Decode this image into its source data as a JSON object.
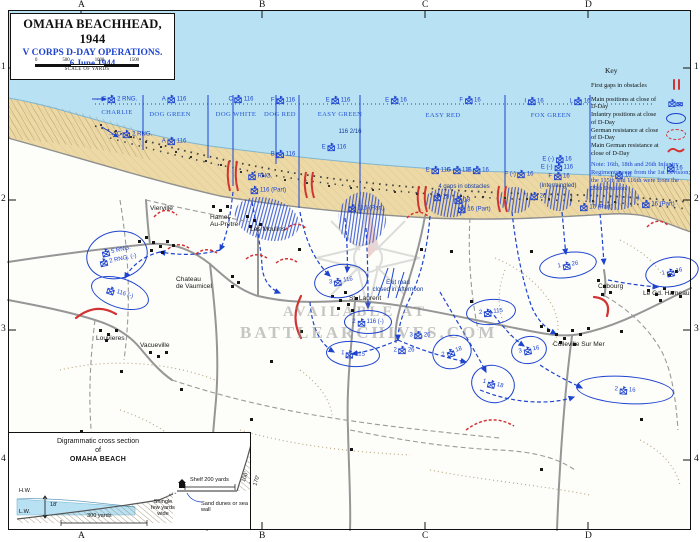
{
  "title_box": {
    "title": "OMAHA BEACHHEAD, 1944",
    "subtitle": "V CORPS D-DAY OPERATIONS.",
    "date": "6 June 1944",
    "scale_ticks": [
      "0",
      "500",
      "1000",
      "1500"
    ],
    "scale_caption": "SCALE OF YARDS"
  },
  "grid": {
    "columns": [
      "A",
      "B",
      "C",
      "D"
    ],
    "rows": [
      "1",
      "2",
      "3",
      "4"
    ]
  },
  "key": {
    "title": "Key",
    "entries": [
      {
        "label": "First gaps in obstacles",
        "symbol": "red-gap-bars"
      },
      {
        "label": "Main positions at close of D-Day",
        "symbol": "blue-unit-flag"
      },
      {
        "label": "Infantry positions at close of D-Day",
        "symbol": "blue-oval"
      },
      {
        "label": "German resistance at close of D-Day",
        "symbol": "red-dashed-oval"
      },
      {
        "label": "Main German resistance at close of D-Day",
        "symbol": "red-wavy-line"
      }
    ],
    "note": "Note: 16th, 18th and 26th Infantry Regiments were from the 1st Division; the 115th and 116th were from the 29th Division."
  },
  "watermark": {
    "line1": "AVAILABLE AT",
    "line2": "BATTLEARCHIVES.COM"
  },
  "colors": {
    "sea": "#b8e1f3",
    "sand": "#ecd9a5",
    "unit_blue": "#1d43cf",
    "resistance_red": "#d23333",
    "road_gray": "#969696"
  },
  "map": {
    "sectors": [
      {
        "name": "CHARLIE",
        "x": 117,
        "y": 109
      },
      {
        "name": "DOG GREEN",
        "x": 170,
        "y": 111
      },
      {
        "name": "DOG WHITE",
        "x": 236,
        "y": 111
      },
      {
        "name": "DOG RED",
        "x": 280,
        "y": 111
      },
      {
        "name": "EASY GREEN",
        "x": 340,
        "y": 111
      },
      {
        "name": "EASY RED",
        "x": 443,
        "y": 112
      },
      {
        "name": "FOX GREEN",
        "x": 551,
        "y": 112
      }
    ],
    "towns": [
      {
        "name": "Vierville",
        "x": 150,
        "y": 205
      },
      {
        "name": "Hamel-\nAu-Pretre",
        "x": 210,
        "y": 214
      },
      {
        "name": "Les Moulins",
        "x": 250,
        "y": 226
      },
      {
        "name": "Chateau\nde Vaumicel",
        "x": 176,
        "y": 276
      },
      {
        "name": "Louvieres",
        "x": 96,
        "y": 335
      },
      {
        "name": "Vacueville",
        "x": 140,
        "y": 342
      },
      {
        "name": "St. Laurent",
        "x": 349,
        "y": 295
      },
      {
        "name": "Colleville Sur Mer",
        "x": 553,
        "y": 341
      },
      {
        "name": "Cabourg",
        "x": 598,
        "y": 283
      },
      {
        "name": "Le Gd. Hameau",
        "x": 643,
        "y": 290
      }
    ],
    "flags": [
      {
        "pre": "C",
        "num": "2 RNG.",
        "x": 115,
        "y": 99,
        "arrow": true
      },
      {
        "pre": "A",
        "num": "116",
        "x": 174,
        "y": 99
      },
      {
        "pre": "C",
        "num": "116",
        "x": 241,
        "y": 99
      },
      {
        "pre": "F",
        "num": "116",
        "x": 283,
        "y": 100
      },
      {
        "pre": "E",
        "num": "116",
        "x": 338,
        "y": 100
      },
      {
        "pre": "E",
        "num": "16",
        "x": 396,
        "y": 100
      },
      {
        "pre": "F",
        "num": "16",
        "x": 470,
        "y": 100
      },
      {
        "pre": "I",
        "num": "16",
        "x": 534,
        "y": 101
      },
      {
        "pre": "L",
        "num": "16",
        "x": 580,
        "y": 101
      },
      {
        "pre": "C",
        "num": "2 RNG.",
        "x": 130,
        "y": 134,
        "arrow": true
      },
      {
        "pre": "A",
        "num": "116",
        "x": 174,
        "y": 141
      },
      {
        "pre": "B",
        "num": "116",
        "x": 283,
        "y": 154
      },
      {
        "pre": "E",
        "num": "116",
        "x": 334,
        "y": 147
      },
      {
        "pre": "",
        "num": "RNG.",
        "x": 260,
        "y": 176
      },
      {
        "pre": "",
        "num": "116 (Part)",
        "x": 268,
        "y": 190
      },
      {
        "pre": "",
        "num": "116 (Part)",
        "x": 366,
        "y": 208
      },
      {
        "pre": "E",
        "num": "116",
        "x": 438,
        "y": 170
      },
      {
        "pre": "G",
        "num": "116",
        "x": 459,
        "y": 170
      },
      {
        "pre": "E",
        "num": "16",
        "x": 478,
        "y": 170
      },
      {
        "pre": "F (-)",
        "num": "16",
        "x": 519,
        "y": 174
      },
      {
        "pre": "",
        "num": "18",
        "x": 441,
        "y": 197
      },
      {
        "pre": "",
        "num": "18",
        "x": 462,
        "y": 200
      },
      {
        "pre": "",
        "num": "16 (Part)",
        "x": 474,
        "y": 209
      },
      {
        "pre": "E (-)",
        "num": "16",
        "x": 557,
        "y": 159
      },
      {
        "pre": "E (-)",
        "num": "116",
        "x": 557,
        "y": 167
      },
      {
        "pre": "F",
        "num": "16",
        "x": 559,
        "y": 176
      },
      {
        "pre": "",
        "num": "26",
        "x": 538,
        "y": 196
      },
      {
        "pre": "",
        "num": "16 (Part)",
        "x": 596,
        "y": 207
      },
      {
        "pre": "L",
        "num": "16",
        "x": 621,
        "y": 175
      },
      {
        "pre": "I",
        "num": "16",
        "x": 673,
        "y": 168
      },
      {
        "pre": "",
        "num": "16 (Part)",
        "x": 658,
        "y": 204
      },
      {
        "pre": "3",
        "num": "26",
        "x": 420,
        "y": 335
      },
      {
        "pre": "2",
        "num": "26",
        "x": 404,
        "y": 350
      }
    ],
    "ovals": [
      {
        "lines": [
          {
            "pre": "",
            "num": "5 RNG."
          },
          {
            "pre": "",
            "num": "2 RNG. (-)"
          }
        ],
        "x": 117,
        "y": 255,
        "rx": 31,
        "ry": 24,
        "rot": -12
      },
      {
        "lines": [
          {
            "pre": "",
            "num": "116 (-)"
          }
        ],
        "x": 120,
        "y": 293,
        "rx": 30,
        "ry": 15,
        "rot": 18
      },
      {
        "lines": [
          {
            "pre": "3",
            "num": "116"
          }
        ],
        "x": 341,
        "y": 281,
        "rx": 27,
        "ry": 17,
        "rot": -8
      },
      {
        "lines": [
          {
            "pre": "2",
            "num": "116 (-)"
          }
        ],
        "x": 368,
        "y": 322,
        "rx": 24,
        "ry": 12,
        "rot": 0
      },
      {
        "lines": [
          {
            "pre": "2",
            "num": "115"
          }
        ],
        "x": 491,
        "y": 312,
        "rx": 25,
        "ry": 13,
        "rot": -5
      },
      {
        "lines": [
          {
            "pre": "1",
            "num": "115"
          }
        ],
        "x": 353,
        "y": 354,
        "rx": 27,
        "ry": 13,
        "rot": 4
      },
      {
        "lines": [
          {
            "pre": "2",
            "num": "18"
          }
        ],
        "x": 452,
        "y": 352,
        "rx": 20,
        "ry": 17,
        "rot": -18
      },
      {
        "lines": [
          {
            "pre": "1",
            "num": "18"
          }
        ],
        "x": 493,
        "y": 384,
        "rx": 22,
        "ry": 19,
        "rot": 14
      },
      {
        "lines": [
          {
            "pre": "3",
            "num": "16"
          }
        ],
        "x": 529,
        "y": 350,
        "rx": 18,
        "ry": 14,
        "rot": -10
      },
      {
        "lines": [
          {
            "pre": "2",
            "num": "16"
          }
        ],
        "x": 625,
        "y": 390,
        "rx": 49,
        "ry": 14,
        "rot": 4
      },
      {
        "lines": [
          {
            "pre": "1",
            "num": "26"
          }
        ],
        "x": 568,
        "y": 265,
        "rx": 29,
        "ry": 13,
        "rot": -8
      },
      {
        "lines": [
          {
            "pre": "1",
            "num": "16"
          }
        ],
        "x": 672,
        "y": 272,
        "rx": 27,
        "ry": 15,
        "rot": -10
      }
    ],
    "notes": [
      {
        "text": "4 gaps in obstacles",
        "x": 464,
        "y": 184
      },
      {
        "text": "(Intermingled)",
        "x": 558,
        "y": 183
      },
      {
        "text": "116  2/16",
        "x": 350,
        "y": 129
      },
      {
        "text": "Exit road\nclosed in afternoon",
        "x": 398,
        "y": 280
      }
    ]
  },
  "cross_section": {
    "title_line1": "Digrammatic cross section",
    "title_line2": "of",
    "title_line3": "OMAHA BEACH",
    "high_water": "H.W.",
    "low_water": "L.W.",
    "tide_range": "18'",
    "beach_width": "300 yards",
    "shingle": "Shingle\nfew yards\nwide",
    "shelf": "Shelf 200 yards",
    "dunes": "Sand dunes or sea wall",
    "bluff_height": "100' - 170'"
  }
}
